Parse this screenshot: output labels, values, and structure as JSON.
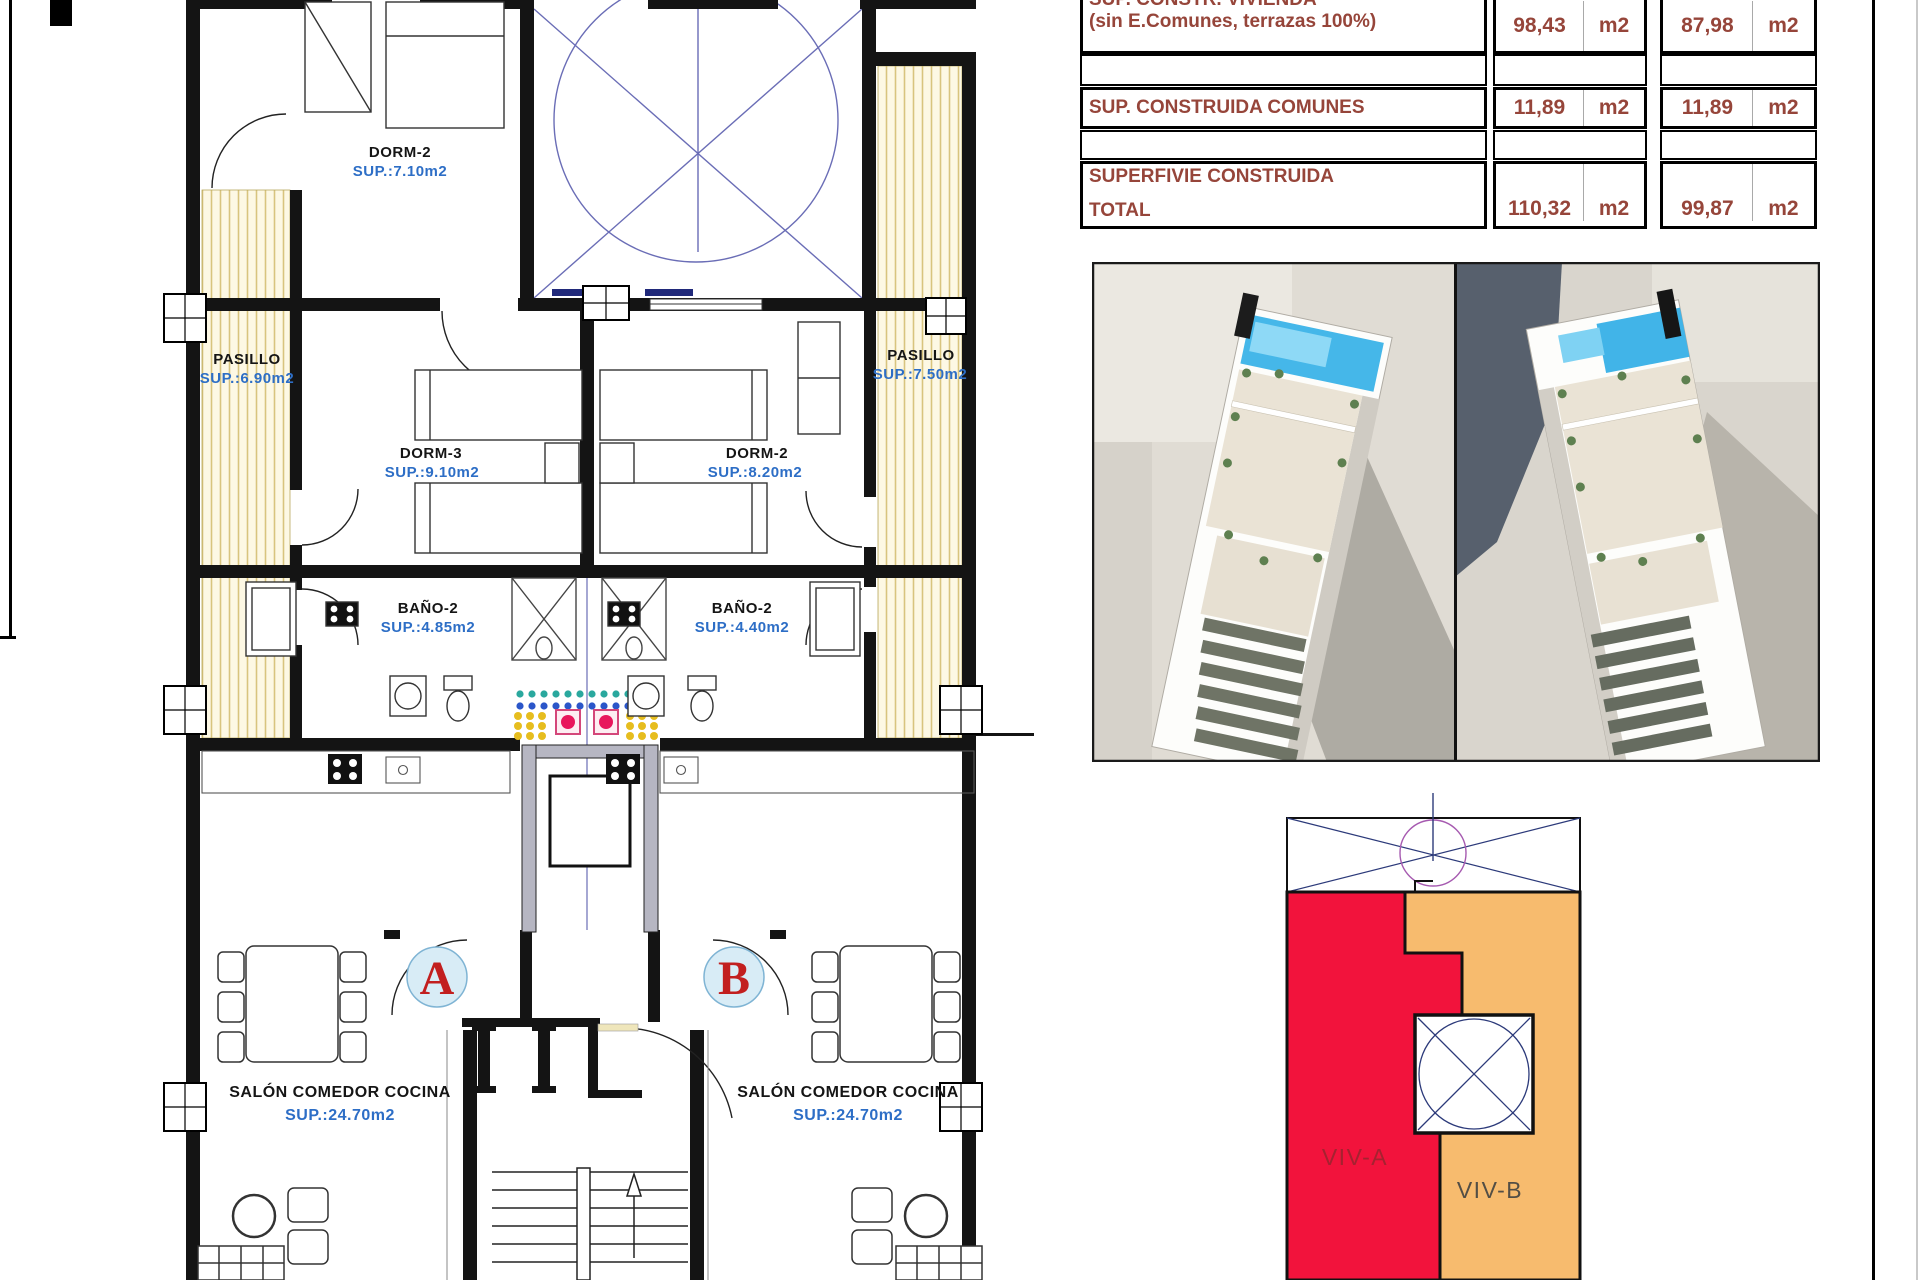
{
  "plan": {
    "rooms": {
      "dorm2_top": {
        "name": "DORM-2",
        "sup": "SUP.:7.10m2"
      },
      "pasillo_left": {
        "name": "PASILLO",
        "sup": "SUP.:6.90m2"
      },
      "pasillo_right": {
        "name": "PASILLO",
        "sup": "SUP.:7.50m2"
      },
      "dorm3": {
        "name": "DORM-3",
        "sup": "SUP.:9.10m2"
      },
      "dorm2_mid": {
        "name": "DORM-2",
        "sup": "SUP.:8.20m2"
      },
      "bano2_left": {
        "name": "BAÑO-2",
        "sup": "SUP.:4.85m2"
      },
      "bano2_right": {
        "name": "BAÑO-2",
        "sup": "SUP.:4.40m2"
      },
      "salon_left": {
        "name": "SALÓN COMEDOR COCINA",
        "sup": "SUP.:24.70m2"
      },
      "salon_right": {
        "name": "SALÓN COMEDOR COCINA",
        "sup": "SUP.:24.70m2"
      }
    },
    "markers": {
      "unit_a": "A",
      "unit_b": "B"
    },
    "label_color": "#151515",
    "sup_color": "#2d6ec6",
    "marker_color": "#c21f1f"
  },
  "area_table": {
    "text_color": "#96453a",
    "rows": [
      {
        "label1": "SUP. CONSTR. VIVIENDA",
        "label2": "(sin E.Comunes, terrazas 100%)",
        "a_value": "98,43",
        "a_unit": "m2",
        "b_value": "87,98",
        "b_unit": "m2"
      },
      {
        "label1": "SUP. CONSTRUIDA COMUNES",
        "label2": "",
        "a_value": "11,89",
        "a_unit": "m2",
        "b_value": "11,89",
        "b_unit": "m2"
      },
      {
        "label1": "SUPERFIVIE CONSTRUIDA",
        "label2": "TOTAL",
        "a_value": "110,32",
        "a_unit": "m2",
        "b_value": "99,87",
        "b_unit": "m2"
      }
    ]
  },
  "viv_diagram": {
    "viv_a": "VIV-A",
    "viv_b": "VIV-B",
    "viv_a_fill": "#f2133c",
    "viv_b_fill": "#f7bb6e",
    "viv_a_text": "#a52230",
    "viv_b_text": "#534e45"
  }
}
